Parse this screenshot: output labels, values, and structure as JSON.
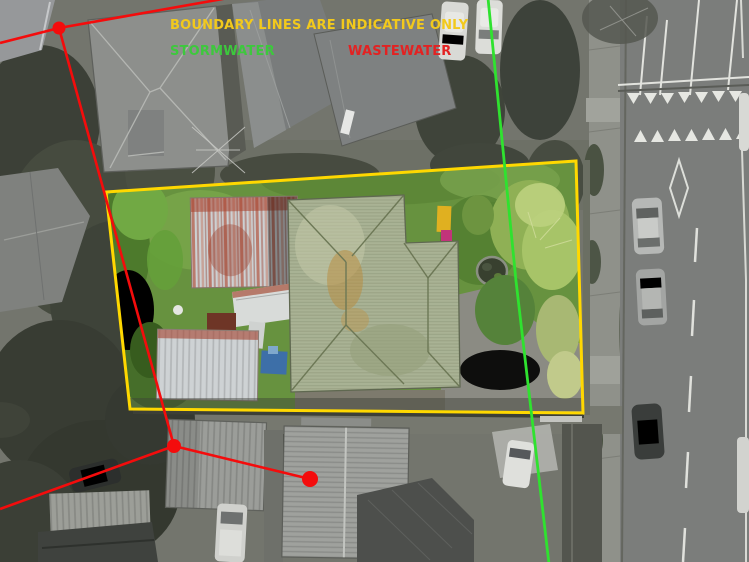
{
  "overlay": {
    "disclaimer": "BOUNDARY LINES ARE INDICATIVE ONLY",
    "stormwater_label": "STORMWATER",
    "wastewater_label": "WASTEWATER",
    "colors": {
      "boundary_line": "#FFD800",
      "disclaimer_text": "#F2C91C",
      "stormwater_line": "#2FE22F",
      "stormwater_text": "#3DC83D",
      "wastewater_line": "#F40C0C",
      "wastewater_text": "#E32222"
    }
  }
}
